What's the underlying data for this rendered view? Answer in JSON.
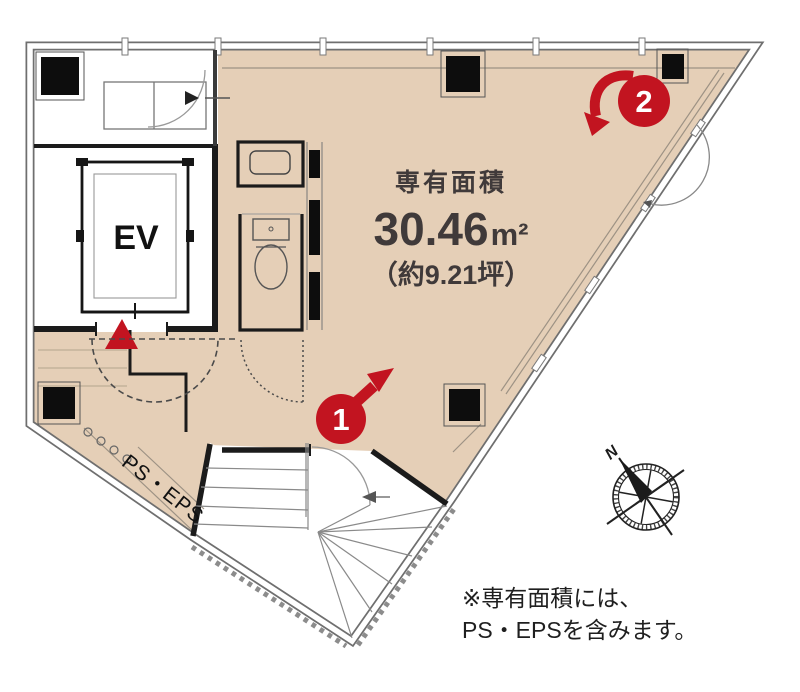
{
  "plan": {
    "area_caption": "専有面積",
    "area_value": "30.46",
    "area_unit": "m²",
    "area_tsubo": "（約9.21坪）",
    "elevator_label": "EV",
    "ps_eps_label": "PS・EPS",
    "marker_1_label": "1",
    "marker_2_label": "2",
    "compass_north_label": "N"
  },
  "note": {
    "line_1": "※専有面積には、",
    "line_2": "PS・EPSを含みます。"
  },
  "colors": {
    "floor": "#e5cfb7",
    "marker_red": "#c21420",
    "wall_dark": "#1b1b1b"
  }
}
